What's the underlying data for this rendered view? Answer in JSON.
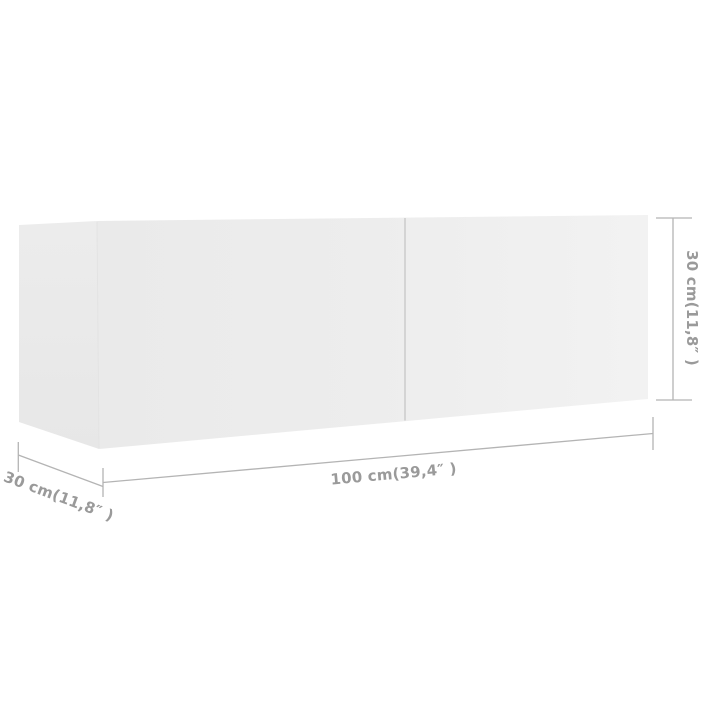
{
  "figure": {
    "type": "product-dimension-diagram",
    "subject": "wall-mounted-tv-cabinet",
    "background_color": "#ffffff",
    "line_color": "#b4b4b4",
    "label_color": "#9a9a9a",
    "cabinet_face_color_left": "#eaeaea",
    "cabinet_face_color_right": "#f2f2f2",
    "door_divider_color": "#cbcbcb",
    "dimensions": {
      "width": {
        "label": "100 cm(39,4″ )",
        "value_cm": "100",
        "value_in": "39,4"
      },
      "depth": {
        "label": "30 cm(11,8″ )",
        "value_cm": "30",
        "value_in": "11,8"
      },
      "height": {
        "label": "30 cm(11,8″ )",
        "value_cm": "30",
        "value_in": "11,8"
      }
    }
  }
}
